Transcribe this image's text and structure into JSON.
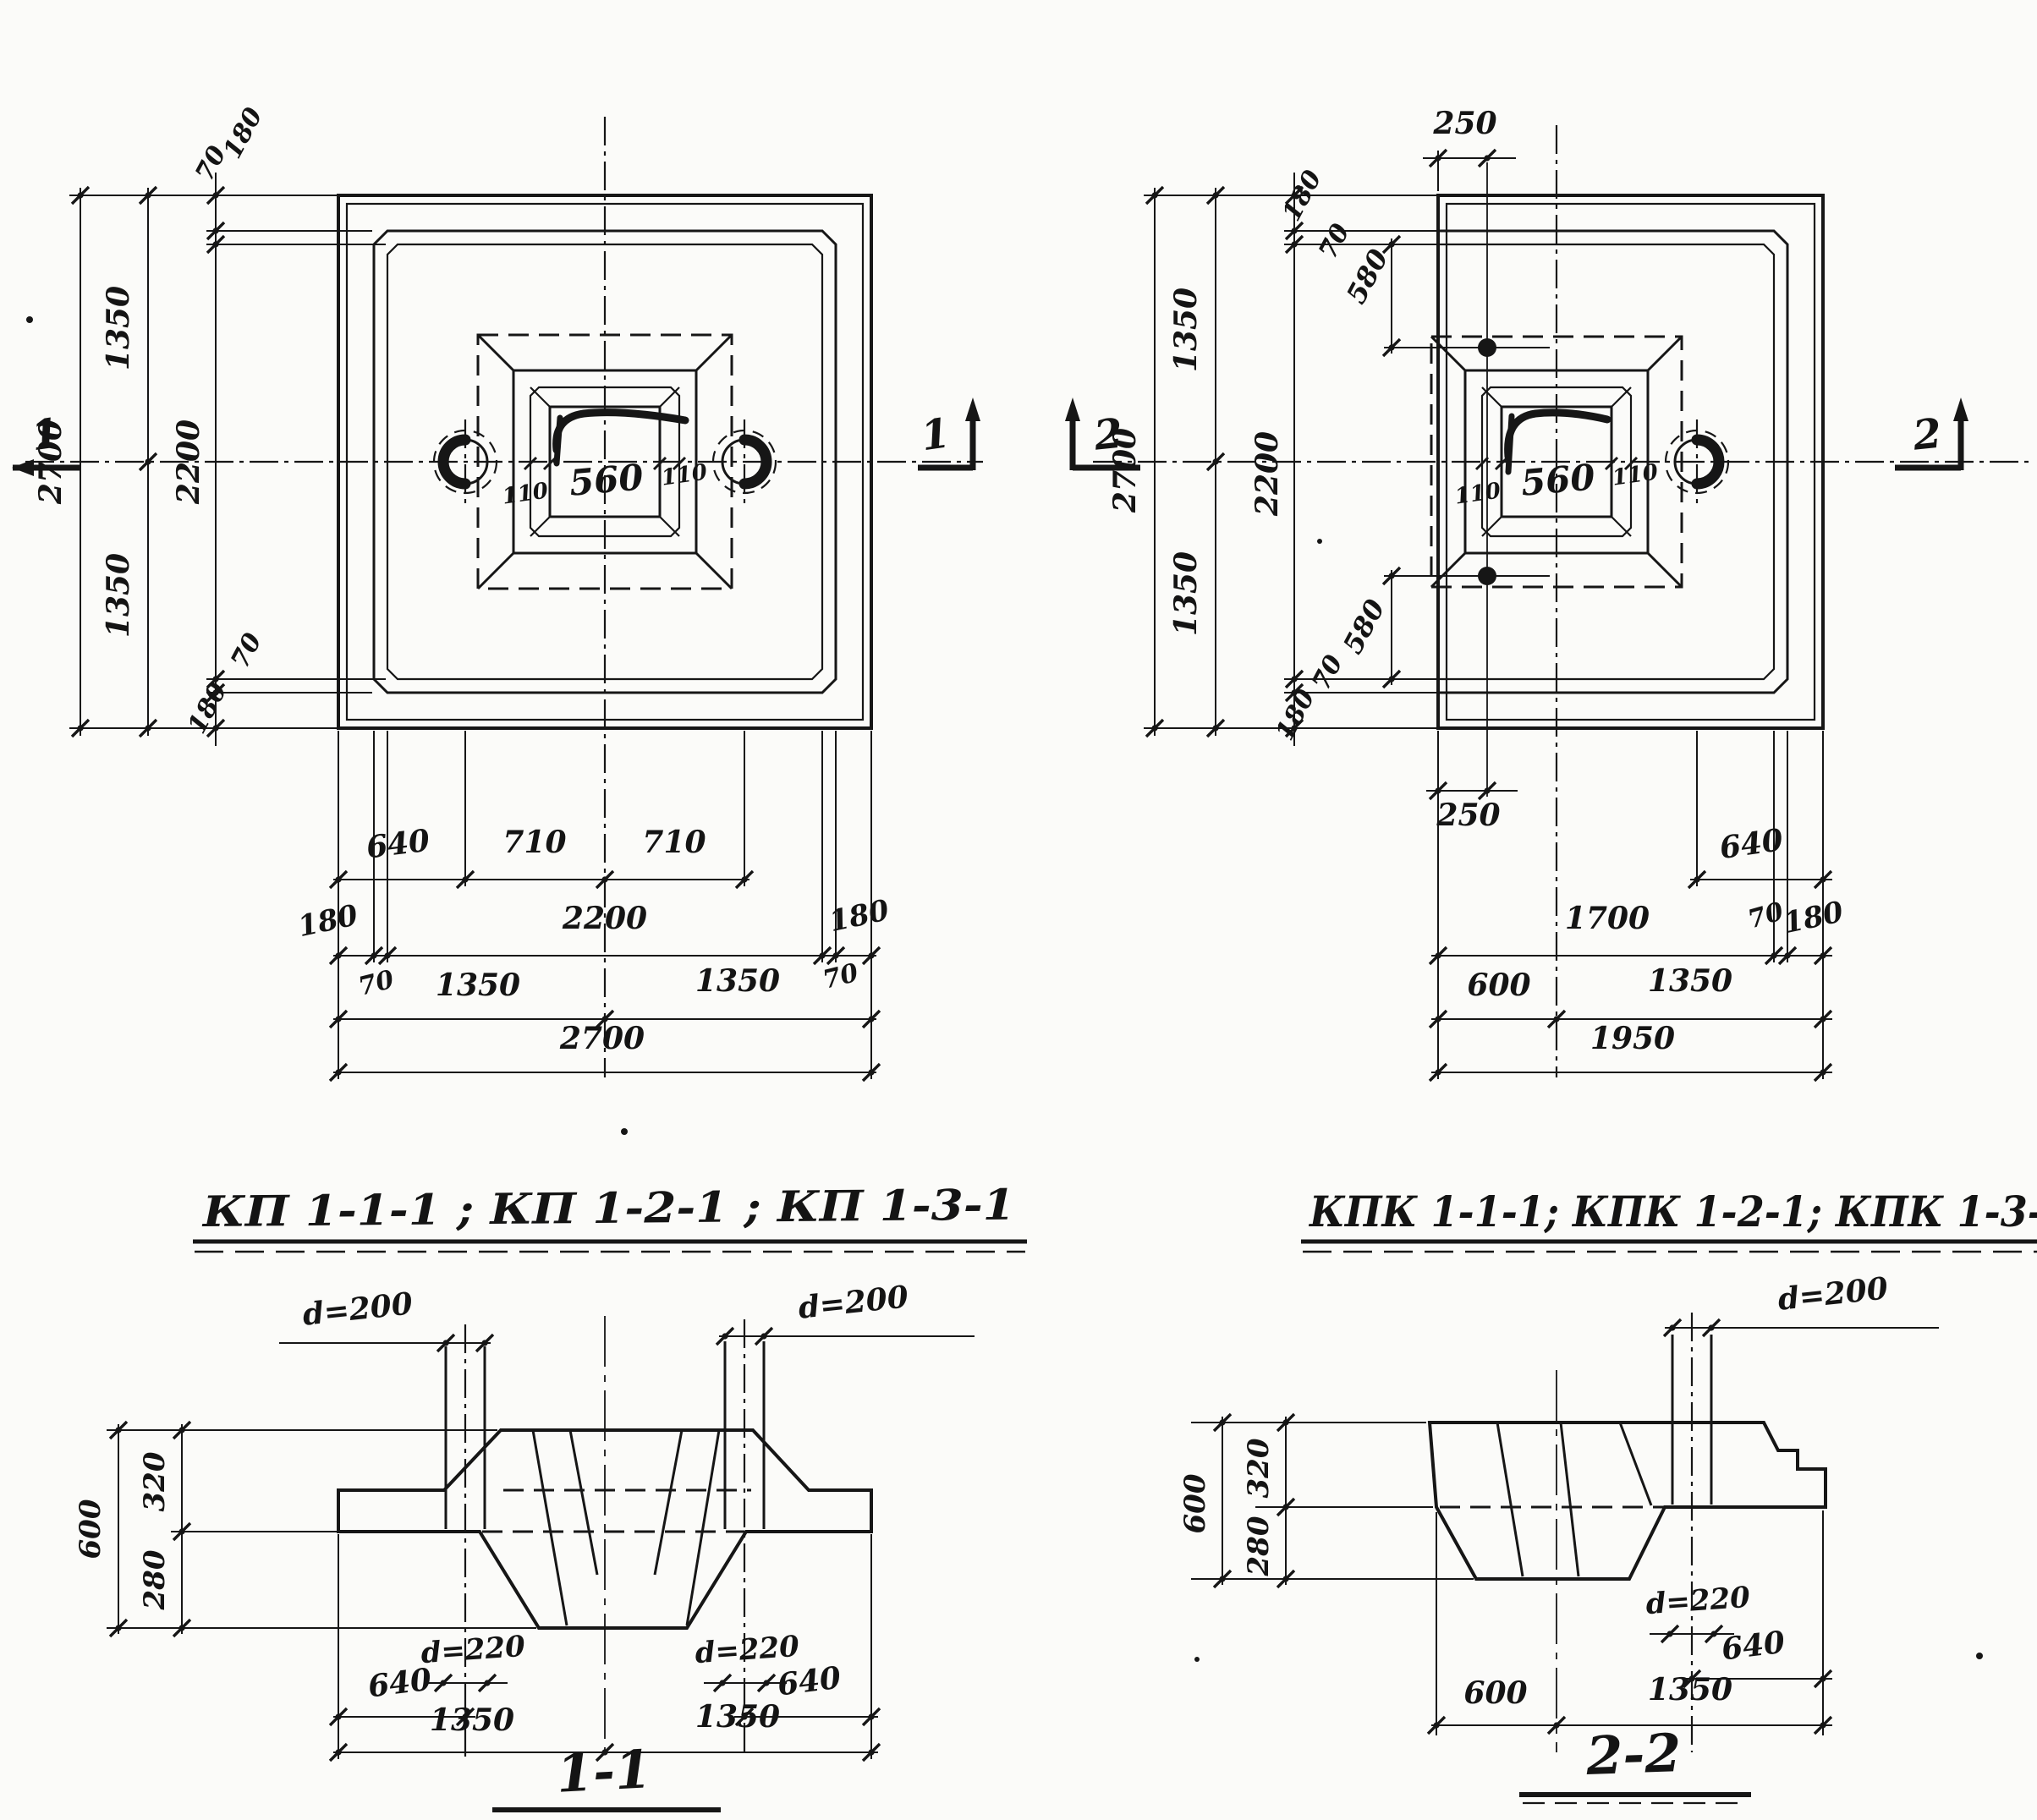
{
  "plans": {
    "kp": {
      "title": "КП 1-1-1 ; КП 1-2-1 ; КП 1-3-1",
      "marker": "1",
      "side_dims": {
        "a180_top": "180",
        "a70_top": "70",
        "h1350_top": "1350",
        "h2700": "2700",
        "h2200": "2200",
        "h1350_bot": "1350",
        "a70_bot": "70",
        "a180_bot": "180"
      },
      "center_dims": {
        "left110": "110",
        "w560": "560",
        "right110": "110"
      },
      "bottom_rows": {
        "row1": [
          "640",
          "710",
          "710"
        ],
        "row2": [
          "180",
          "2200",
          "180"
        ],
        "row2_under": [
          "70",
          "70"
        ],
        "row3": [
          "1350",
          "1350"
        ],
        "row4": "2700"
      }
    },
    "kpk": {
      "title": "КПК 1-1-1; КПК 1-2-1; КПК 1-3-1",
      "marker": "2",
      "top_dim": "250",
      "side_dims": {
        "a180_top": "180",
        "a70_top": "70",
        "a580_top": "580",
        "h1350_top": "1350",
        "h2700": "2700",
        "h2200": "2200",
        "h1350_bot": "1350",
        "a580_bot": "580",
        "a70_bot": "70",
        "a180_bot": "180"
      },
      "center_dims": {
        "left110": "110",
        "w560": "560",
        "right110": "110"
      },
      "bottom_rows": {
        "dim250": "250",
        "dim640": "640",
        "row2": [
          "1700",
          "70",
          "180"
        ],
        "row3": [
          "600",
          "1350"
        ],
        "row4": "1950"
      }
    }
  },
  "sections": {
    "s11": {
      "title": "1-1",
      "pipe_left": "d=200",
      "pipe_right": "d=200",
      "sleeve_left": "d=220",
      "sleeve_right": "d=220",
      "heights": {
        "total": "600",
        "upper": "320",
        "lower": "280"
      },
      "off_left": "640",
      "off_right": "640",
      "bottom": [
        "1350",
        "1350"
      ]
    },
    "s22": {
      "title": "2-2",
      "pipe": "d=200",
      "sleeve": "d=220",
      "heights": {
        "total": "600",
        "upper": "320",
        "lower": "280"
      },
      "off": "640",
      "bottom": [
        "600",
        "1350"
      ]
    }
  }
}
